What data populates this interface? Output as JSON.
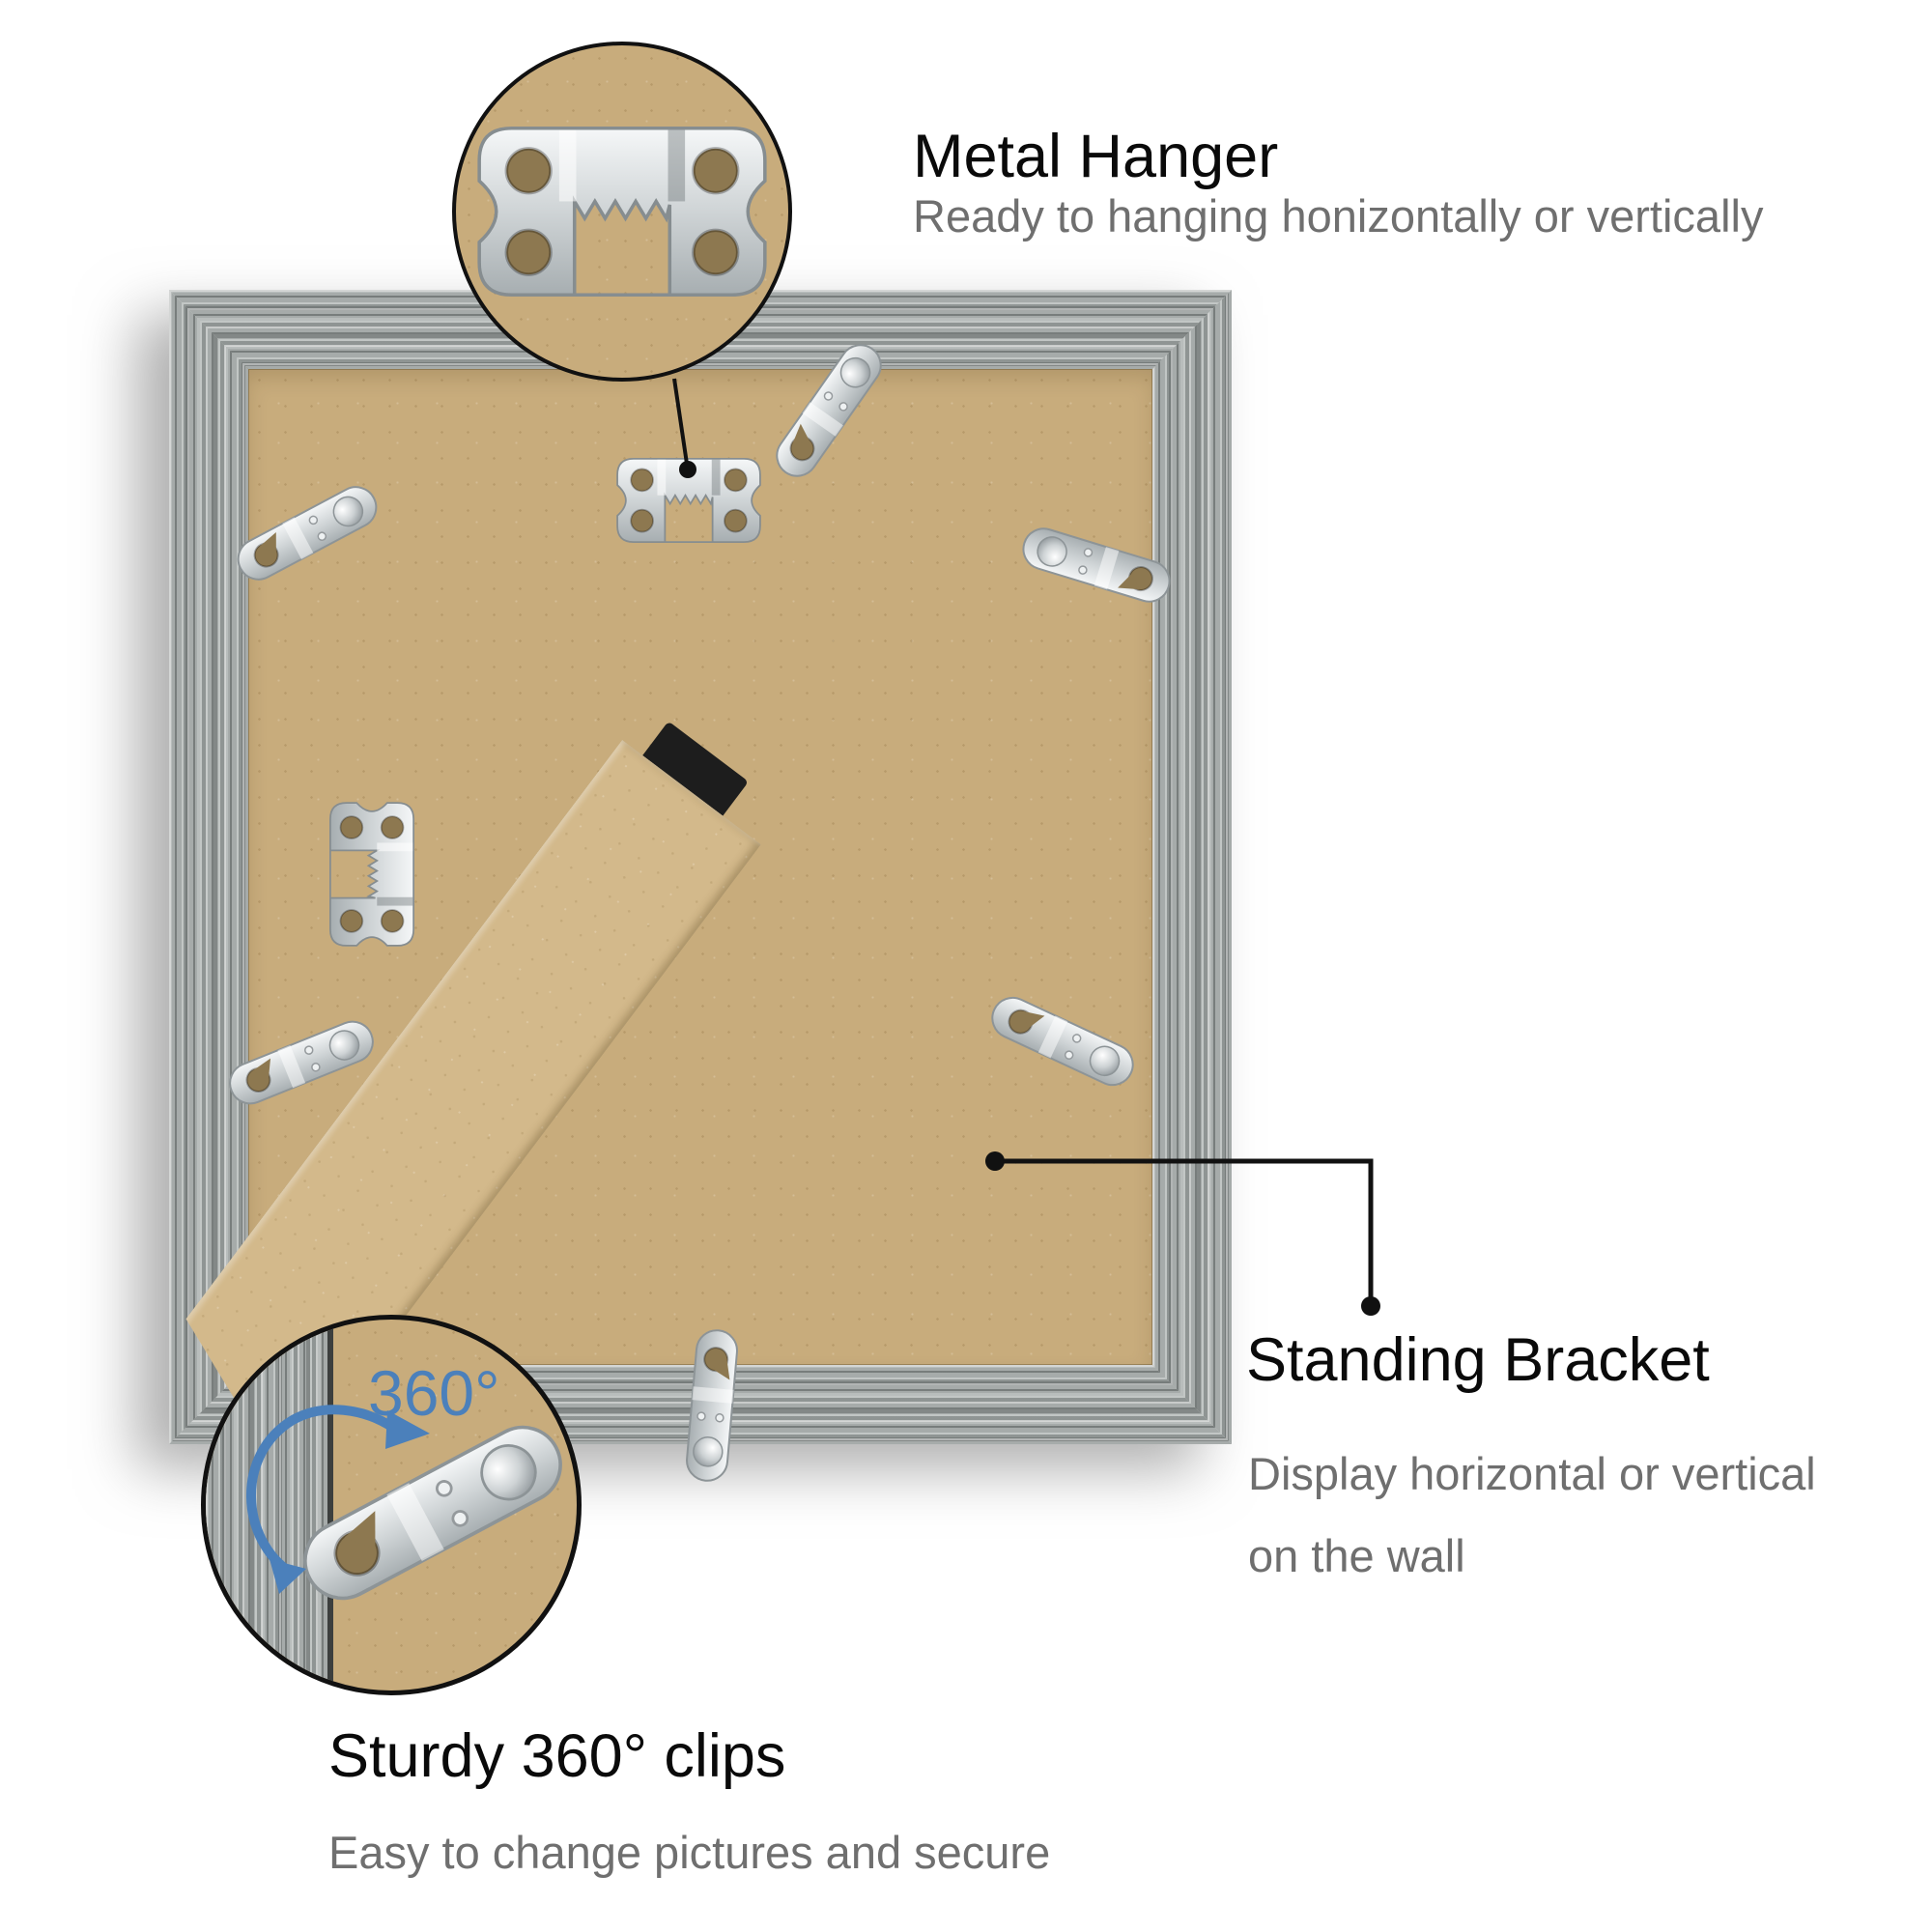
{
  "callouts": {
    "metal_hanger": {
      "title": "Metal Hanger",
      "subtitle": "Ready to hanging honizontally or vertically"
    },
    "standing_bracket": {
      "title": "Standing Bracket",
      "subtitle_line1": "Display horizontal or vertical",
      "subtitle_line2": "on the wall"
    },
    "sturdy_clips": {
      "title": "Sturdy 360° clips",
      "subtitle": "Easy to change pictures and secure",
      "rotation_label": "360°"
    }
  },
  "colors": {
    "heading_text": "#0a0a0a",
    "subtitle_text": "#6f6f6f",
    "accent_blue": "#4b80bb",
    "frame_gray": "#a6abaa",
    "backing_tan": "#c8ac7c",
    "bracket_tan": "#d3b98b",
    "metal_silver": "#d9dde0",
    "callout_line": "#111111"
  }
}
